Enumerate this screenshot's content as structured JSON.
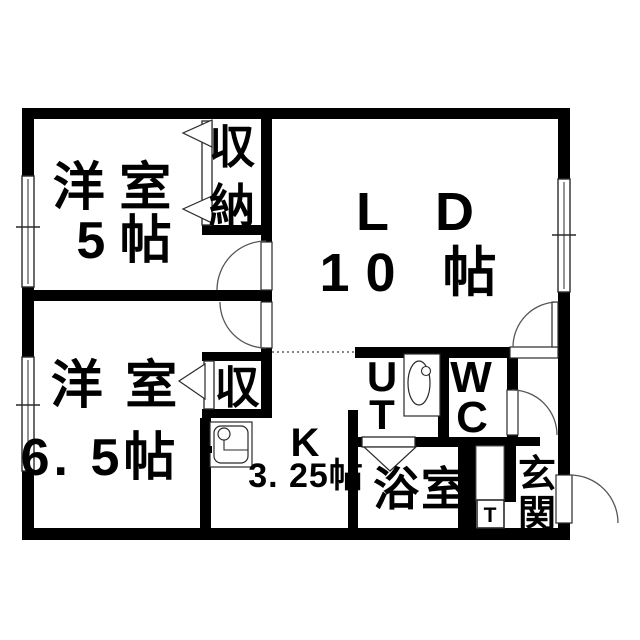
{
  "meta": {
    "kind": "japanese-apartment-floor-plan",
    "title": "2LDK floor plan"
  },
  "colors": {
    "background": "#ffffff",
    "wall": "#000000",
    "thin_line": "#2a2a2a",
    "arc_line": "#555555",
    "dotted_line": "#888888",
    "text": "#000000"
  },
  "rooms": [
    {
      "name": "洋室",
      "size": "5帖"
    },
    {
      "name": "洋室",
      "size": "6.5帖"
    },
    {
      "name": "LD",
      "size": "10帖"
    },
    {
      "name": "K",
      "size": "3.25帖"
    },
    {
      "name": "収納"
    },
    {
      "name": "収"
    },
    {
      "name": "UT"
    },
    {
      "name": "WC"
    },
    {
      "name": "浴室"
    },
    {
      "name": "玄関"
    },
    {
      "name": "T"
    }
  ],
  "plan": {
    "canvas": {
      "w": 640,
      "h": 640
    },
    "walls": [
      [
        22,
        108,
        548,
        11
      ],
      [
        22,
        528,
        548,
        12
      ],
      [
        22,
        108,
        12,
        68
      ],
      [
        22,
        287,
        12,
        70
      ],
      [
        22,
        471,
        12,
        57
      ],
      [
        558,
        108,
        12,
        71
      ],
      [
        558,
        292,
        12,
        183
      ],
      [
        558,
        523,
        12,
        17
      ],
      [
        34,
        290,
        238,
        11
      ],
      [
        261,
        119,
        11,
        123
      ],
      [
        261,
        290,
        11,
        12
      ],
      [
        261,
        348,
        11,
        13
      ],
      [
        202,
        225,
        69,
        10
      ],
      [
        202,
        352,
        70,
        9
      ],
      [
        202,
        409,
        70,
        9
      ],
      [
        261,
        352,
        11,
        66
      ],
      [
        200,
        418,
        11,
        110
      ],
      [
        355,
        347,
        155,
        11
      ],
      [
        438,
        358,
        11,
        88
      ],
      [
        507,
        358,
        11,
        32
      ],
      [
        507,
        435,
        11,
        11
      ],
      [
        438,
        437,
        102,
        9
      ],
      [
        348,
        437,
        14,
        10
      ],
      [
        415,
        437,
        43,
        10
      ],
      [
        348,
        410,
        10,
        118
      ],
      [
        458,
        437,
        18,
        91
      ],
      [
        504,
        446,
        12,
        56
      ]
    ],
    "windows": [
      {
        "id": "window-west-room5",
        "rect": [
          22,
          176,
          12,
          111
        ],
        "tick_y": 227,
        "orient": "v"
      },
      {
        "id": "window-west-room65",
        "rect": [
          22,
          357,
          12,
          114
        ],
        "tick_y": 405,
        "orient": "v"
      },
      {
        "id": "window-ld",
        "rect": [
          558,
          179,
          12,
          113
        ],
        "tick_y": 235,
        "orient": "v"
      }
    ],
    "swing_doors": [
      {
        "id": "door-west-room5",
        "gap": [
          261,
          242,
          11,
          48
        ],
        "arc": "M 217 290 A 49 49 0 0 1 266 241"
      },
      {
        "id": "door-west-room65",
        "gap": [
          261,
          302,
          11,
          46
        ],
        "arc": "M 220 302 A 46 46 0 0 0 266 348"
      },
      {
        "id": "door-ld-hall",
        "gap": [
          510,
          347,
          48,
          11
        ],
        "leaf": [
          552,
          302,
          6,
          45
        ],
        "arc": "M 513 347 A 45 45 0 0 1 558 302"
      },
      {
        "id": "door-wc",
        "gap": [
          507,
          390,
          11,
          45
        ],
        "arc": "M 512 390 A 45 45 0 0 1 557 435"
      },
      {
        "id": "door-entrance",
        "gap": [
          556,
          475,
          16,
          48
        ],
        "arc": "M 570 475 A 48 48 0 0 1 618 523"
      }
    ],
    "closet_doors": [
      {
        "id": "closet-door-shuno",
        "panel": [
          202,
          121,
          10,
          104
        ],
        "triangles": [
          [
            [
              212,
              120
            ],
            [
              212,
              147
            ],
            [
              183,
              133
            ]
          ],
          [
            [
              212,
              196
            ],
            [
              212,
              223
            ],
            [
              183,
              209
            ]
          ]
        ]
      },
      {
        "id": "closet-door-shu",
        "panel": [
          204,
          361,
          10,
          48
        ],
        "triangles": [
          [
            [
              205,
              364
            ],
            [
              205,
              399
            ],
            [
              179,
              381
            ]
          ]
        ]
      },
      {
        "id": "bath-door",
        "panel": [
          362,
          437,
          53,
          10
        ],
        "triangles": [
          [
            [
              364,
              447
            ],
            [
              416,
              447
            ],
            [
              390,
              471
            ]
          ]
        ]
      }
    ],
    "dotted_boundary": {
      "id": "ld-kitchen-boundary",
      "path": "M 272 352 L 356 352"
    },
    "fixtures": {
      "kitchen_sink": {
        "outer": [
          210,
          422,
          42,
          45
        ],
        "basin": [
          214,
          426,
          34,
          37,
          7
        ],
        "faucet_circle": [
          224,
          434,
          6
        ],
        "faucet_line": "M 224 440 L 224 450 L 248 450",
        "tick": [
          205,
          446,
          7,
          7
        ]
      },
      "ut_basin": {
        "outer": [
          404,
          354,
          36,
          62
        ],
        "bowl_ellipse": [
          419,
          383,
          11,
          22
        ],
        "faucet_circle": [
          426,
          371,
          4.5
        ]
      },
      "meter_box": {
        "rect": [
          477,
          500,
          27,
          28
        ]
      },
      "pipe_space": {
        "rect": [
          476,
          446,
          28,
          55
        ]
      }
    },
    "labels": [
      {
        "id": "label-west-room5",
        "fs": 52,
        "ls": 0,
        "lines": [
          {
            "t": "洋 室",
            "x": 112,
            "y": 205
          },
          {
            "t": "5 帖",
            "x": 124,
            "y": 258
          }
        ]
      },
      {
        "id": "label-ld",
        "fs": 54,
        "ls": 16,
        "lines": [
          {
            "t": "L D",
            "x": 423,
            "y": 230
          },
          {
            "t": "10 帖",
            "x": 416,
            "y": 291
          }
        ]
      },
      {
        "id": "label-west-room65",
        "fs": 52,
        "ls": 4,
        "lines": [
          {
            "t": "洋 室",
            "x": 116,
            "y": 403
          },
          {
            "t": "6. 5帖",
            "x": 100,
            "y": 475
          }
        ]
      },
      {
        "id": "label-kitchen",
        "fs": 40,
        "ls": 0,
        "lines": [
          {
            "t": "K",
            "x": 305,
            "y": 456
          }
        ]
      },
      {
        "id": "label-kitchen-size",
        "fs": 34,
        "ls": 1,
        "lines": [
          {
            "t": "3. 25帖",
            "x": 306,
            "y": 487
          }
        ]
      },
      {
        "id": "label-shuno",
        "fs": 46,
        "ls": 0,
        "lines": [
          {
            "t": "収",
            "x": 232,
            "y": 163
          },
          {
            "t": "納",
            "x": 232,
            "y": 222
          }
        ]
      },
      {
        "id": "label-shu",
        "fs": 45,
        "ls": 0,
        "lines": [
          {
            "t": "収",
            "x": 237,
            "y": 403
          }
        ]
      },
      {
        "id": "label-ut",
        "fs": 42,
        "ls": 0,
        "lines": [
          {
            "t": "U",
            "x": 382,
            "y": 391
          },
          {
            "t": "T",
            "x": 382,
            "y": 429
          }
        ]
      },
      {
        "id": "label-wc",
        "fs": 44,
        "ls": 0,
        "lines": [
          {
            "t": "W",
            "x": 471,
            "y": 392
          },
          {
            "t": "C",
            "x": 472,
            "y": 432
          }
        ]
      },
      {
        "id": "label-bathroom",
        "fs": 46,
        "ls": 2,
        "lines": [
          {
            "t": "浴室",
            "x": 421,
            "y": 505
          }
        ]
      },
      {
        "id": "label-entrance",
        "fs": 38,
        "ls": 0,
        "lines": [
          {
            "t": "玄",
            "x": 537,
            "y": 487
          },
          {
            "t": "関",
            "x": 537,
            "y": 527
          }
        ]
      },
      {
        "id": "label-meter-box",
        "fs": 21,
        "ls": 0,
        "lines": [
          {
            "t": "T",
            "x": 490,
            "y": 522
          }
        ]
      }
    ]
  }
}
